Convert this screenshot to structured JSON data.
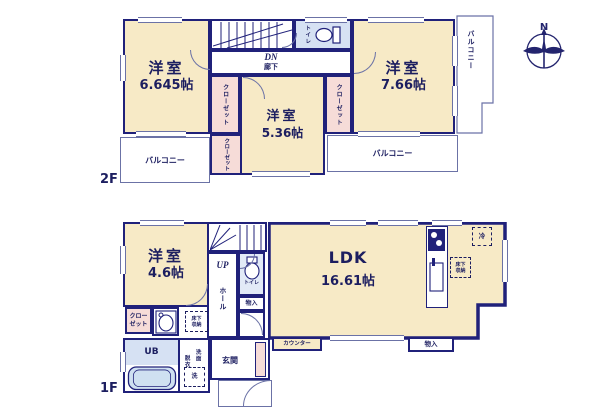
{
  "compass": {
    "north": "N"
  },
  "colors": {
    "wall": "#20217a",
    "room_fill": "#f7eac6",
    "closet_fill": "#f6dcd8",
    "wet_area_fill": "#d6e1f3",
    "outline": "#6b72a6"
  },
  "f2": {
    "label": "2F",
    "bedroom1_name": "洋室",
    "bedroom1_size": "6.645帖",
    "bedroom2_name": "洋室",
    "bedroom2_size": "7.66帖",
    "bedroom3_name": "洋室",
    "bedroom3_size": "5.36帖",
    "closet_left": "クローゼット",
    "closet_right": "クローゼット",
    "closet_bottom": "クローゼット",
    "toilet": "トイレ",
    "stairs_direction": "DN",
    "hallway": "廊下",
    "balcony_left": "バルコニー",
    "balcony_bottom": "バルコニー",
    "balcony_side": "バルコニー"
  },
  "f1": {
    "label": "1F",
    "bedroom_name": "洋室",
    "bedroom_size": "4.6帖",
    "ldk_name": "LDK",
    "ldk_size": "16.61帖",
    "stairs_direction": "UP",
    "hall": "ホール",
    "toilet": "トイレ",
    "storage_hall": "物入",
    "pipe_space": "PS",
    "closet": "クローゼット",
    "underfloor_storage_left": "床下収納",
    "underfloor_storage_right": "床下収納",
    "dressing_room": "脱衣室",
    "washbasin": "洗面",
    "washer": "洗",
    "unit_bath": "UB",
    "entrance": "玄関",
    "counter": "カウンター",
    "storage_ldk": "物入",
    "fridge": "冷"
  }
}
